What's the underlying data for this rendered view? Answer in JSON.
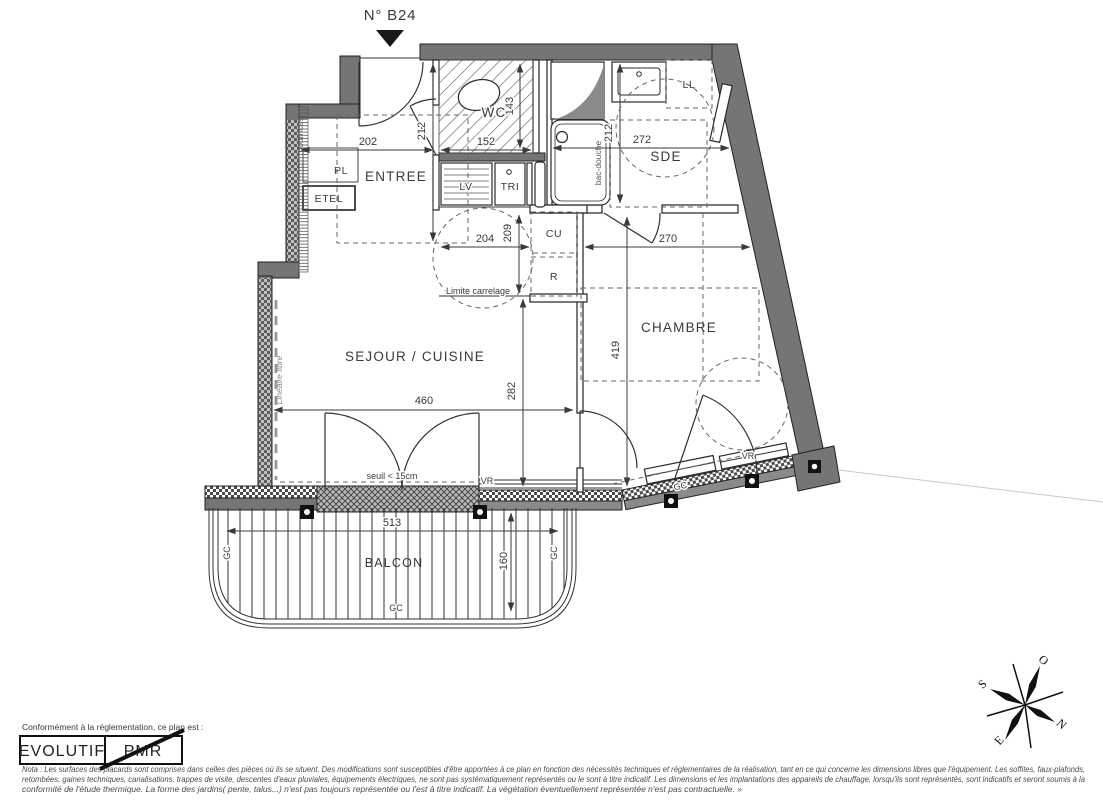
{
  "plan": {
    "number": "N° B24"
  },
  "rooms": {
    "wc": "WC",
    "entree": "ENTREE",
    "sde": "SDE",
    "sejour_cuisine": "SEJOUR / CUISINE",
    "chambre": "CHAMBRE",
    "balcon": "BALCON"
  },
  "closets_equipment": {
    "pl": "PL",
    "etel": "ETEL",
    "lv": "LV",
    "tri": "TRI",
    "cu": "CU",
    "r": "R",
    "ll": "LL"
  },
  "dimensions_cm": {
    "entree_width": "202",
    "entree_depth": "212",
    "wc_width": "152",
    "wc_depth": "143",
    "sde_width": "272",
    "sde_depth": "212",
    "kitchen_width": "204",
    "kitchen_depth": "209",
    "chambre_width": "270",
    "chambre_depth": "419",
    "sejour_width": "460",
    "sejour_depth": "282",
    "balcon_width": "513",
    "balcon_depth": "160"
  },
  "annotations": {
    "nourrices": "nourrices",
    "bac_douche": "bac-douche",
    "limite_carrelage": "Limite carrelage",
    "lineaire_libre": "Linéaire libre",
    "seuil": "seuil < 15cm",
    "vr": "VR",
    "gc": "GC"
  },
  "compass": {
    "north": "N",
    "south": "S",
    "east": "E",
    "west": "O"
  },
  "stamp": {
    "caption": "Conformément à la réglementation, ce plan est :",
    "option_evolutif": "EVOLUTIF",
    "option_pmr": "PMR"
  },
  "nota": {
    "line1": "Nota : Les surfaces des placards sont comprises dans celles des pièces où ils se situent. Des modifications sont susceptibles d'être apportées à ce plan en fonction des nécessités techniques et réglementaires de la réalisation, tant en ce qui concerne les dimensions libres que l'équipement.  Les soffites, faux-plafonds,",
    "line2": "retombées, gaines techniques, canalisations, trappes de visite, descentes d'eaux pluviales, équipements électriques, ne sont pas systématiquement représentés ou le sont à titre indicatif. Les dimensions et les implantations des appareils de chauffage, lorsqu'ils sont représentés, sont indicatifs et seront soumis à la",
    "line3": "conformité de l'étude thermique. La forme des jardins( pente, talus...) n'est pas toujours représentée ou l'est à titre indicatif. La végétation éventuellement représentée n'est pas contractuelle. »"
  },
  "colors": {
    "wall": "#757575",
    "line": "#222222",
    "paper": "#ffffff"
  }
}
